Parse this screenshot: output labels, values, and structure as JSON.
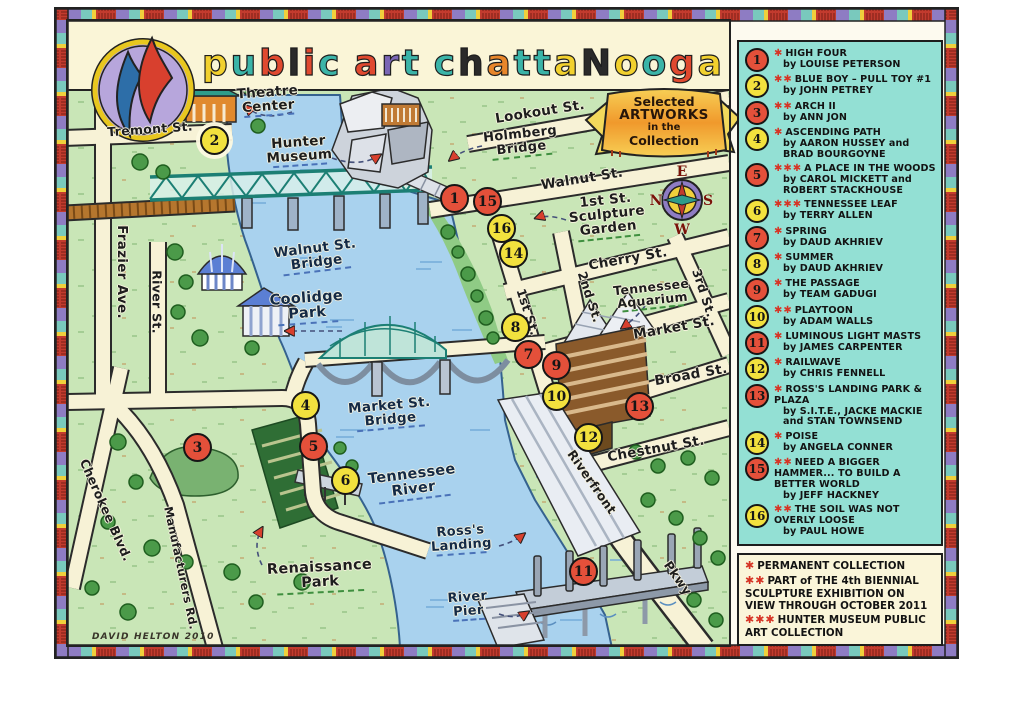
{
  "title": {
    "text": "public art chattanooga",
    "letters": [
      {
        "ch": "p",
        "color": "#f2d12e"
      },
      {
        "ch": "u",
        "color": "#3bb4a8"
      },
      {
        "ch": "b",
        "color": "#e0492f"
      },
      {
        "ch": "l",
        "color": "#2a2a2a"
      },
      {
        "ch": "i",
        "color": "#e0492f"
      },
      {
        "ch": "c",
        "color": "#3bb4a8"
      },
      {
        "ch": " "
      },
      {
        "ch": "a",
        "color": "#e0492f"
      },
      {
        "ch": "r",
        "color": "#7a66b5"
      },
      {
        "ch": "t",
        "color": "#3bb4a8"
      },
      {
        "ch": " "
      },
      {
        "ch": "c",
        "color": "#3bb4a8"
      },
      {
        "ch": "h",
        "color": "#2a2a2a"
      },
      {
        "ch": "a",
        "color": "#e8862a"
      },
      {
        "ch": "t",
        "color": "#3bb4a8"
      },
      {
        "ch": "t",
        "color": "#3bb4a8"
      },
      {
        "ch": "a",
        "color": "#f2d12e"
      },
      {
        "ch": "N",
        "color": "#2a2a2a"
      },
      {
        "ch": "o",
        "color": "#f2d12e"
      },
      {
        "ch": "o",
        "color": "#3bb4a8"
      },
      {
        "ch": "g",
        "color": "#e0492f"
      },
      {
        "ch": "a",
        "color": "#f2d12e"
      }
    ]
  },
  "banner": {
    "lines": [
      "Selected",
      "ARTWORKS",
      "in the",
      "Collection"
    ]
  },
  "signature": "DAVID HELTON 2010",
  "compass": {
    "top": "E",
    "left": "N",
    "right": "S",
    "bottom": "W"
  },
  "map": {
    "labels": [
      {
        "text": "Tremont St.",
        "x": 150,
        "y": 129,
        "rot": -4,
        "size": 12.5,
        "cls": "street"
      },
      {
        "text": "Frazier Ave.",
        "x": 122,
        "y": 272,
        "rot": 90,
        "size": 13.5,
        "cls": "street"
      },
      {
        "text": "River St.",
        "x": 157,
        "y": 302,
        "rot": 90,
        "size": 12.5,
        "cls": "street"
      },
      {
        "text": "Cherokee Blvd.",
        "x": 106,
        "y": 510,
        "rot": 66,
        "size": 12.5,
        "cls": "street"
      },
      {
        "text": "Manufacturers Rd.",
        "x": 181,
        "y": 568,
        "rot": 78,
        "size": 11.5,
        "cls": "street"
      },
      {
        "text": "Lookout St.",
        "x": 540,
        "y": 112,
        "rot": -9,
        "size": 13.5,
        "cls": "street"
      },
      {
        "text": "Walnut St.",
        "x": 582,
        "y": 179,
        "rot": -9,
        "size": 13.5,
        "cls": "street"
      },
      {
        "text": "Cherry St.",
        "x": 628,
        "y": 259,
        "rot": -10,
        "size": 13.5,
        "cls": "street"
      },
      {
        "text": "Market St.",
        "x": 674,
        "y": 328,
        "rot": -10,
        "size": 13.5,
        "cls": "street"
      },
      {
        "text": "Broad St.",
        "x": 691,
        "y": 375,
        "rot": -10,
        "size": 13.5,
        "cls": "street"
      },
      {
        "text": "Chestnut St.",
        "x": 656,
        "y": 449,
        "rot": -10,
        "size": 13.5,
        "cls": "street"
      },
      {
        "text": "1st St.",
        "x": 528,
        "y": 312,
        "rot": 72,
        "size": 12.5,
        "cls": "street"
      },
      {
        "text": "2nd St.",
        "x": 590,
        "y": 297,
        "rot": 72,
        "size": 12.5,
        "cls": "street"
      },
      {
        "text": "3rd St.",
        "x": 704,
        "y": 293,
        "rot": 72,
        "size": 12.5,
        "cls": "street"
      },
      {
        "text": "Riverfront",
        "x": 592,
        "y": 482,
        "rot": 55,
        "size": 12.5,
        "cls": "street"
      },
      {
        "text": "Pkwy",
        "x": 678,
        "y": 578,
        "rot": 55,
        "size": 12.5,
        "cls": "street"
      },
      {
        "text": "Walnut St.\nBridge",
        "x": 316,
        "y": 257,
        "rot": -7,
        "size": 13.5,
        "cls": "water u-blue"
      },
      {
        "text": "Coolidge\nPark",
        "x": 307,
        "y": 308,
        "rot": -4,
        "size": 14.5,
        "cls": "water u-blue"
      },
      {
        "text": "Market St.\nBridge",
        "x": 390,
        "y": 414,
        "rot": -5,
        "size": 13.5,
        "cls": "water u-blue"
      },
      {
        "text": "Tennessee\nRiver",
        "x": 413,
        "y": 484,
        "rot": -7,
        "size": 14.5,
        "cls": "water u-blue"
      },
      {
        "text": "Ross's\nLanding",
        "x": 461,
        "y": 540,
        "rot": -4,
        "size": 13,
        "cls": "water u-blue"
      },
      {
        "text": "River\nPier",
        "x": 468,
        "y": 606,
        "rot": -4,
        "size": 13,
        "cls": "water u-blue"
      },
      {
        "text": "Theatre\nCenter",
        "x": 268,
        "y": 101,
        "rot": -4,
        "size": 13.5,
        "cls": "place u-blue"
      },
      {
        "text": "Hunter\nMuseum",
        "x": 299,
        "y": 151,
        "rot": -4,
        "size": 13.5,
        "cls": "place u-blue"
      },
      {
        "text": "Holmberg\nBridge",
        "x": 521,
        "y": 143,
        "rot": -6,
        "size": 13,
        "cls": "place u-green"
      },
      {
        "text": "1st St.\nSculpture\nGarden",
        "x": 607,
        "y": 216,
        "rot": -6,
        "size": 13.5,
        "cls": "place u-green"
      },
      {
        "text": "Tennessee\nAquarium",
        "x": 652,
        "y": 295,
        "rot": -6,
        "size": 12.5,
        "cls": "place u-green"
      },
      {
        "text": "Renaissance\nPark",
        "x": 320,
        "y": 577,
        "rot": -3,
        "size": 14.5,
        "cls": "place u-green"
      }
    ],
    "markers": [
      {
        "num": 1,
        "x": 455,
        "y": 199
      },
      {
        "num": 2,
        "x": 215,
        "y": 141,
        "halo": true
      },
      {
        "num": 3,
        "x": 198,
        "y": 448
      },
      {
        "num": 4,
        "x": 306,
        "y": 406
      },
      {
        "num": 5,
        "x": 314,
        "y": 447
      },
      {
        "num": 6,
        "x": 346,
        "y": 481
      },
      {
        "num": 7,
        "x": 529,
        "y": 355
      },
      {
        "num": 8,
        "x": 516,
        "y": 328
      },
      {
        "num": 9,
        "x": 557,
        "y": 366
      },
      {
        "num": 10,
        "x": 557,
        "y": 397
      },
      {
        "num": 11,
        "x": 584,
        "y": 572
      },
      {
        "num": 12,
        "x": 589,
        "y": 438
      },
      {
        "num": 13,
        "x": 640,
        "y": 407
      },
      {
        "num": 14,
        "x": 514,
        "y": 254
      },
      {
        "num": 15,
        "x": 488,
        "y": 202
      },
      {
        "num": 16,
        "x": 502,
        "y": 229
      }
    ]
  },
  "legend": {
    "items": [
      {
        "num": 1,
        "stars": 1,
        "title": "HIGH FOUR",
        "by": "by LOUISE PETERSON"
      },
      {
        "num": 2,
        "stars": 2,
        "title": "BLUE BOY – PULL TOY #1",
        "by": "by JOHN PETREY"
      },
      {
        "num": 3,
        "stars": 2,
        "title": "ARCH II",
        "by": "by ANN JON"
      },
      {
        "num": 4,
        "stars": 1,
        "title": "ASCENDING PATH",
        "by": "by AARON HUSSEY and BRAD BOURGOYNE"
      },
      {
        "num": 5,
        "stars": 3,
        "title": "A PLACE IN THE WOODS",
        "by": "by CAROL MICKETT and ROBERT STACKHOUSE"
      },
      {
        "num": 6,
        "stars": 3,
        "title": "TENNESSEE LEAF",
        "by": "by TERRY ALLEN"
      },
      {
        "num": 7,
        "stars": 1,
        "title": "SPRING",
        "by": "by DAUD AKHRIEV"
      },
      {
        "num": 8,
        "stars": 1,
        "title": "SUMMER",
        "by": "by DAUD AKHRIEV"
      },
      {
        "num": 9,
        "stars": 1,
        "title": "THE PASSAGE",
        "by": "by TEAM GADUGI"
      },
      {
        "num": 10,
        "stars": 2,
        "title": "PLAYTOON",
        "by": "by ADAM WALLS"
      },
      {
        "num": 11,
        "stars": 1,
        "title": "LUMINOUS LIGHT MASTS",
        "by": "by JAMES CARPENTER"
      },
      {
        "num": 12,
        "stars": 1,
        "title": "RAILWAVE",
        "by": "by CHRIS FENNELL"
      },
      {
        "num": 13,
        "stars": 1,
        "title": "ROSS'S LANDING PARK & PLAZA",
        "by": "by S.I.T.E., JACKE MACKIE and STAN TOWNSEND"
      },
      {
        "num": 14,
        "stars": 1,
        "title": "POISE",
        "by": "by ANGELA CONNER"
      },
      {
        "num": 15,
        "stars": 2,
        "title": "NEED A BIGGER HAMMER... TO BUILD A BETTER WORLD",
        "by": "by JEFF HACKNEY"
      },
      {
        "num": 16,
        "stars": 2,
        "title": "THE SOIL WAS NOT OVERLY LOOSE",
        "by": "by PAUL HOWE"
      }
    ],
    "footnotes": [
      {
        "stars": 1,
        "text": "PERMANENT COLLECTION"
      },
      {
        "stars": 2,
        "text": "PART of THE 4th BIENNIAL SCULPTURE EXHIBITION ON VIEW THROUGH OCTOBER 2011"
      },
      {
        "stars": 3,
        "text": "HUNTER MUSEUM PUBLIC ART COLLECTION"
      }
    ]
  },
  "colors": {
    "marker_red": "#e4503a",
    "marker_yellow": "#f2e13e",
    "star_red": "#d63425",
    "legend_bg": "#93e0d4",
    "panel_cream": "#faf5d9",
    "water": "#a9d2ee",
    "land": "#c9e6b7"
  }
}
